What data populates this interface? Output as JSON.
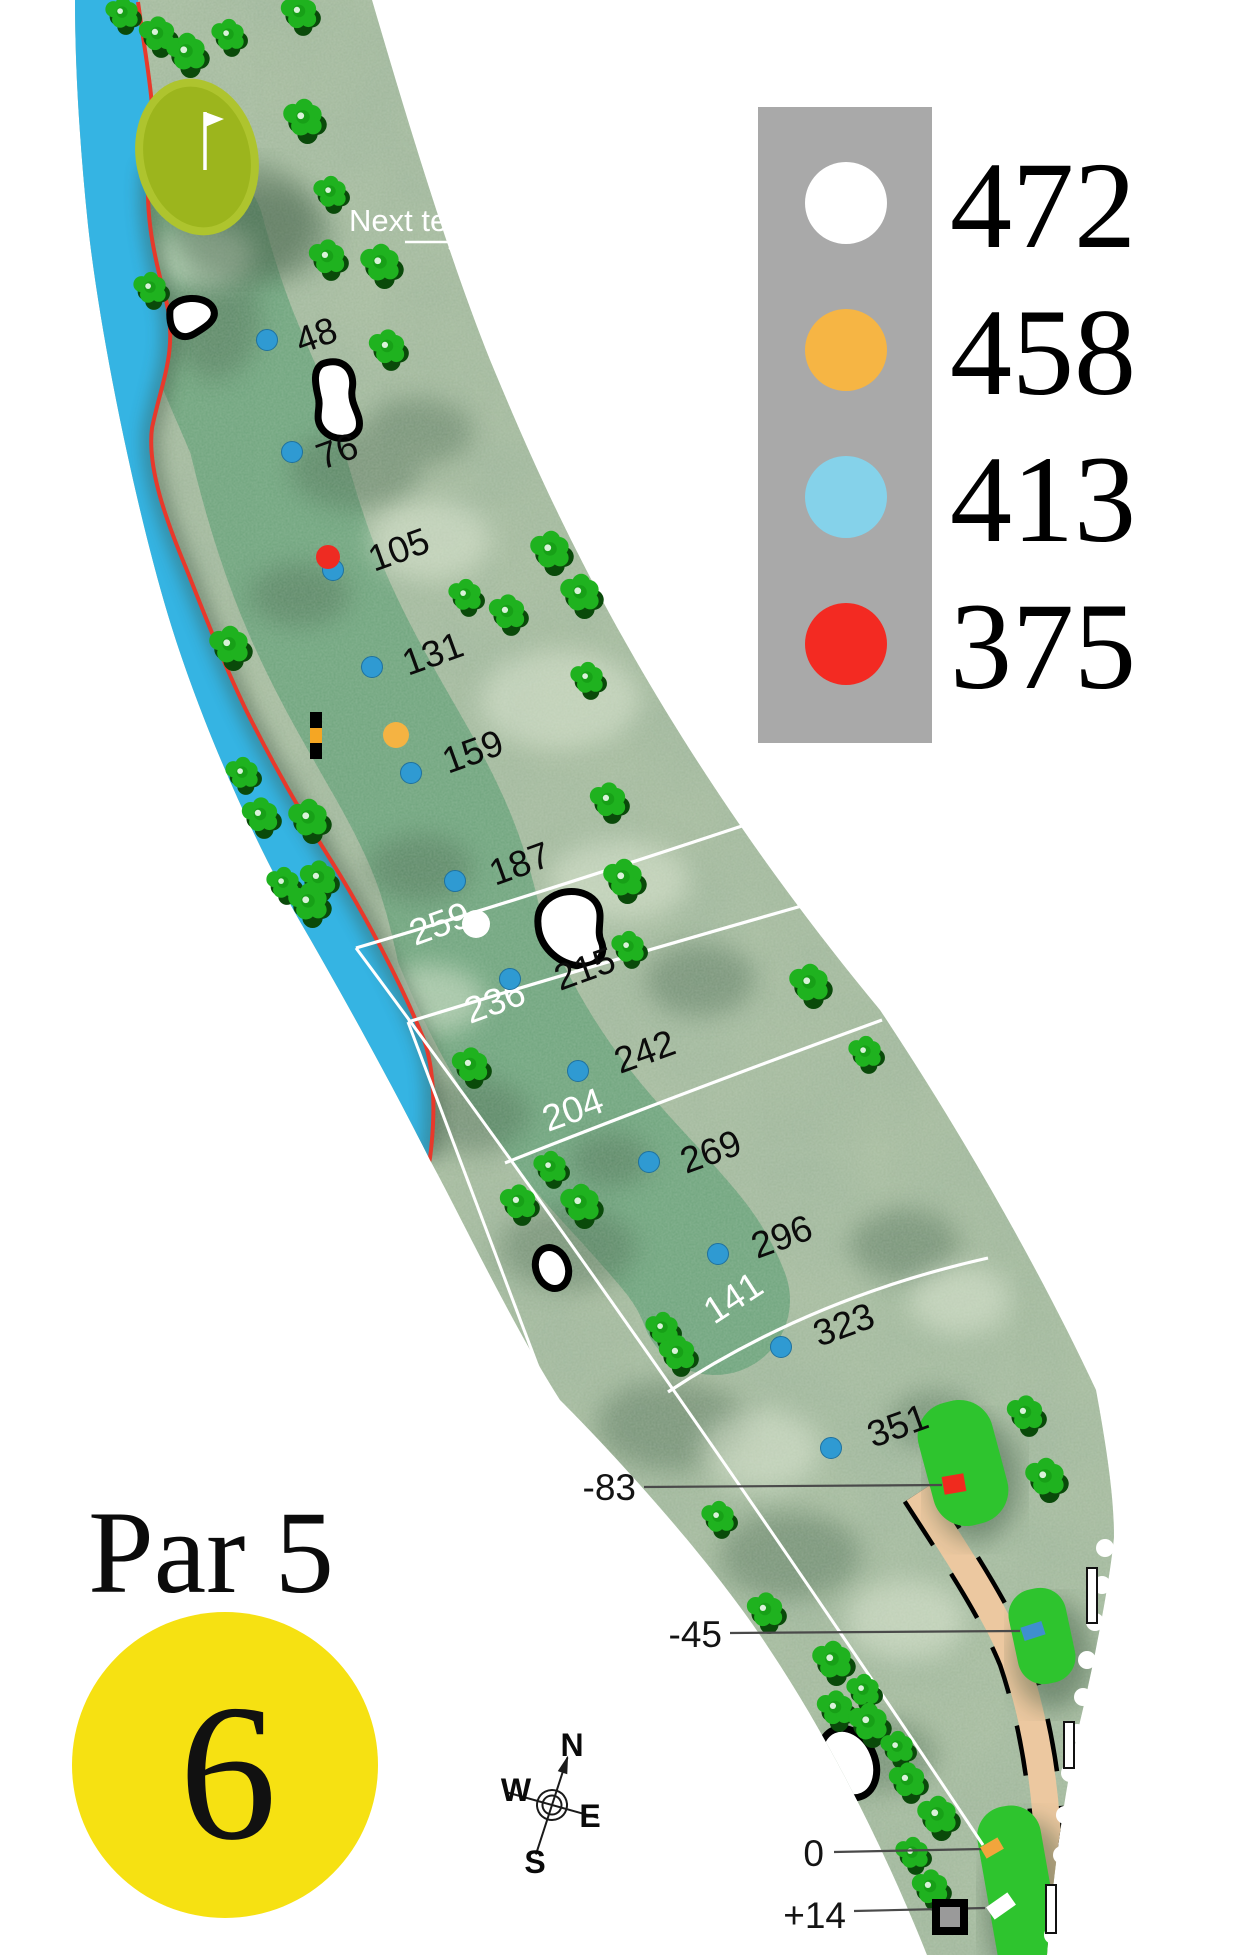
{
  "hole": {
    "par": "Par 5",
    "number": "6"
  },
  "legend": {
    "entries": [
      {
        "tee": "white",
        "color": "#ffffff",
        "distance": "472"
      },
      {
        "tee": "yellow",
        "color": "#f6b544",
        "distance": "458"
      },
      {
        "tee": "blue",
        "color": "#85d2ea",
        "distance": "413"
      },
      {
        "tee": "red",
        "color": "#f32a22",
        "distance": "375"
      }
    ]
  },
  "annotations": {
    "next_tee": "Next tee"
  },
  "compass": {
    "north": "N",
    "east": "E",
    "south": "S",
    "west": "W"
  },
  "colors": {
    "rough": "#a7bc9f",
    "fairway": "#6fa47d",
    "water": "#35b4e3",
    "hazard_line": "#e8392b",
    "green": "#9cb51d",
    "tee_box": "#2ec42e",
    "cart_path": "#ecc8a0",
    "marker_dot": "#2f9ad2",
    "legend_bg": "#a9a9a9",
    "hole_badge": "#f6e112"
  },
  "fairway_markers": [
    {
      "distance": "48",
      "dot": [
        267,
        340
      ],
      "label": [
        301,
        354
      ]
    },
    {
      "distance": "76",
      "dot": [
        292,
        452
      ],
      "label": [
        322,
        470
      ]
    },
    {
      "distance": "105",
      "dot": [
        333,
        570
      ],
      "label": [
        374,
        572
      ]
    },
    {
      "distance": "131",
      "dot": [
        372,
        667
      ],
      "label": [
        408,
        676
      ]
    },
    {
      "distance": "159",
      "dot": [
        411,
        773
      ],
      "label": [
        448,
        774
      ]
    },
    {
      "distance": "187",
      "dot": [
        455,
        881
      ],
      "label": [
        495,
        886
      ]
    },
    {
      "distance": "215",
      "dot": [
        510,
        979
      ],
      "label": [
        560,
        991
      ]
    },
    {
      "distance": "242",
      "dot": [
        578,
        1071
      ],
      "label": [
        620,
        1074
      ]
    },
    {
      "distance": "269",
      "dot": [
        649,
        1162
      ],
      "label": [
        686,
        1174
      ]
    },
    {
      "distance": "296",
      "dot": [
        718,
        1254
      ],
      "label": [
        757,
        1259
      ]
    },
    {
      "distance": "323",
      "dot": [
        781,
        1347
      ],
      "label": [
        819,
        1347
      ]
    },
    {
      "distance": "351",
      "dot": [
        831,
        1448
      ],
      "label": [
        873,
        1448
      ]
    }
  ],
  "shot_markers": [
    {
      "name": "red-shot-marker",
      "color": "#ee2b22",
      "x": 328,
      "y": 557,
      "r": 12
    },
    {
      "name": "yellow-shot-marker",
      "color": "#f5b342",
      "x": 396,
      "y": 735,
      "r": 13
    },
    {
      "name": "white-shot-marker",
      "color": "#ffffff",
      "x": 476,
      "y": 924,
      "r": 14
    }
  ],
  "carry_arcs": [
    {
      "distance": "259",
      "d": "M356,948 Q520,900 760,820",
      "label": [
        415,
        946
      ],
      "rot": -20
    },
    {
      "distance": "236",
      "d": "M408,1022 Q560,975 812,903",
      "label": [
        470,
        1024
      ],
      "rot": -20
    },
    {
      "distance": "204",
      "d": "M505,1163 Q650,1105 882,1020",
      "label": [
        548,
        1132
      ],
      "rot": -20
    },
    {
      "distance": "141",
      "d": "M668,1392 Q810,1298 988,1258",
      "label": [
        714,
        1325
      ],
      "rot": -33
    }
  ],
  "sight_lines": [
    "M983,1845 Q640,1330 356,948",
    "M408,1022 L558,1420"
  ],
  "tee_offsets": [
    {
      "label": "-83",
      "text": [
        636,
        1500
      ],
      "line": [
        644,
        1487,
        942,
        1485
      ],
      "marker": {
        "x": 954,
        "y": 1484,
        "w": 22,
        "h": 18,
        "rot": -10,
        "color": "#f02a1e"
      }
    },
    {
      "label": "-45",
      "text": [
        722,
        1647
      ],
      "line": [
        730,
        1633,
        1020,
        1631
      ],
      "marker": {
        "x": 1033,
        "y": 1631,
        "w": 22,
        "h": 14,
        "rot": -18,
        "color": "#3f8fd0"
      }
    },
    {
      "label": "0",
      "text": [
        824,
        1866
      ],
      "line": [
        834,
        1852,
        983,
        1849
      ],
      "marker": {
        "x": 992,
        "y": 1848,
        "w": 20,
        "h": 13,
        "rot": -30,
        "color": "#f2a53c"
      }
    },
    {
      "label": "+14",
      "text": [
        846,
        1928
      ],
      "line": [
        854,
        1911,
        985,
        1908
      ],
      "marker": {
        "x": 1001,
        "y": 1906,
        "w": 26,
        "h": 15,
        "rot": -35,
        "color": "#ffffff"
      }
    }
  ],
  "ob_markers": {
    "dots": [
      [
        1105,
        1548
      ],
      [
        1102,
        1585
      ],
      [
        1095,
        1622
      ],
      [
        1087,
        1660
      ],
      [
        1083,
        1697
      ],
      [
        1077,
        1733
      ],
      [
        1070,
        1773
      ],
      [
        1065,
        1815
      ],
      [
        1062,
        1855
      ],
      [
        1058,
        1895
      ],
      [
        1053,
        1935
      ]
    ],
    "stakes": [
      [
        1087,
        1568,
        55
      ],
      [
        1064,
        1722,
        46
      ],
      [
        1046,
        1885,
        48
      ]
    ]
  },
  "trees": [
    [
      122,
      13
    ],
    [
      157,
      34
    ],
    [
      186,
      52
    ],
    [
      228,
      35
    ],
    [
      299,
      12
    ],
    [
      303,
      118
    ],
    [
      330,
      192
    ],
    [
      327,
      257
    ],
    [
      380,
      263
    ],
    [
      150,
      288
    ],
    [
      387,
      347
    ],
    [
      550,
      550
    ],
    [
      465,
      595
    ],
    [
      507,
      612
    ],
    [
      580,
      593
    ],
    [
      587,
      678
    ],
    [
      608,
      800
    ],
    [
      623,
      878
    ],
    [
      628,
      947
    ],
    [
      470,
      1065
    ],
    [
      229,
      645
    ],
    [
      242,
      773
    ],
    [
      260,
      815
    ],
    [
      308,
      818
    ],
    [
      283,
      883
    ],
    [
      318,
      878
    ],
    [
      308,
      902
    ],
    [
      550,
      1167
    ],
    [
      518,
      1202
    ],
    [
      580,
      1203
    ],
    [
      662,
      1328
    ],
    [
      677,
      1353
    ],
    [
      809,
      983
    ],
    [
      865,
      1052
    ],
    [
      1025,
      1413
    ],
    [
      1045,
      1477
    ],
    [
      718,
      1517
    ],
    [
      765,
      1610
    ],
    [
      832,
      1660
    ],
    [
      863,
      1690
    ],
    [
      835,
      1708
    ],
    [
      868,
      1722
    ],
    [
      897,
      1747
    ],
    [
      907,
      1780
    ],
    [
      937,
      1815
    ],
    [
      912,
      1853
    ],
    [
      930,
      1887
    ]
  ]
}
